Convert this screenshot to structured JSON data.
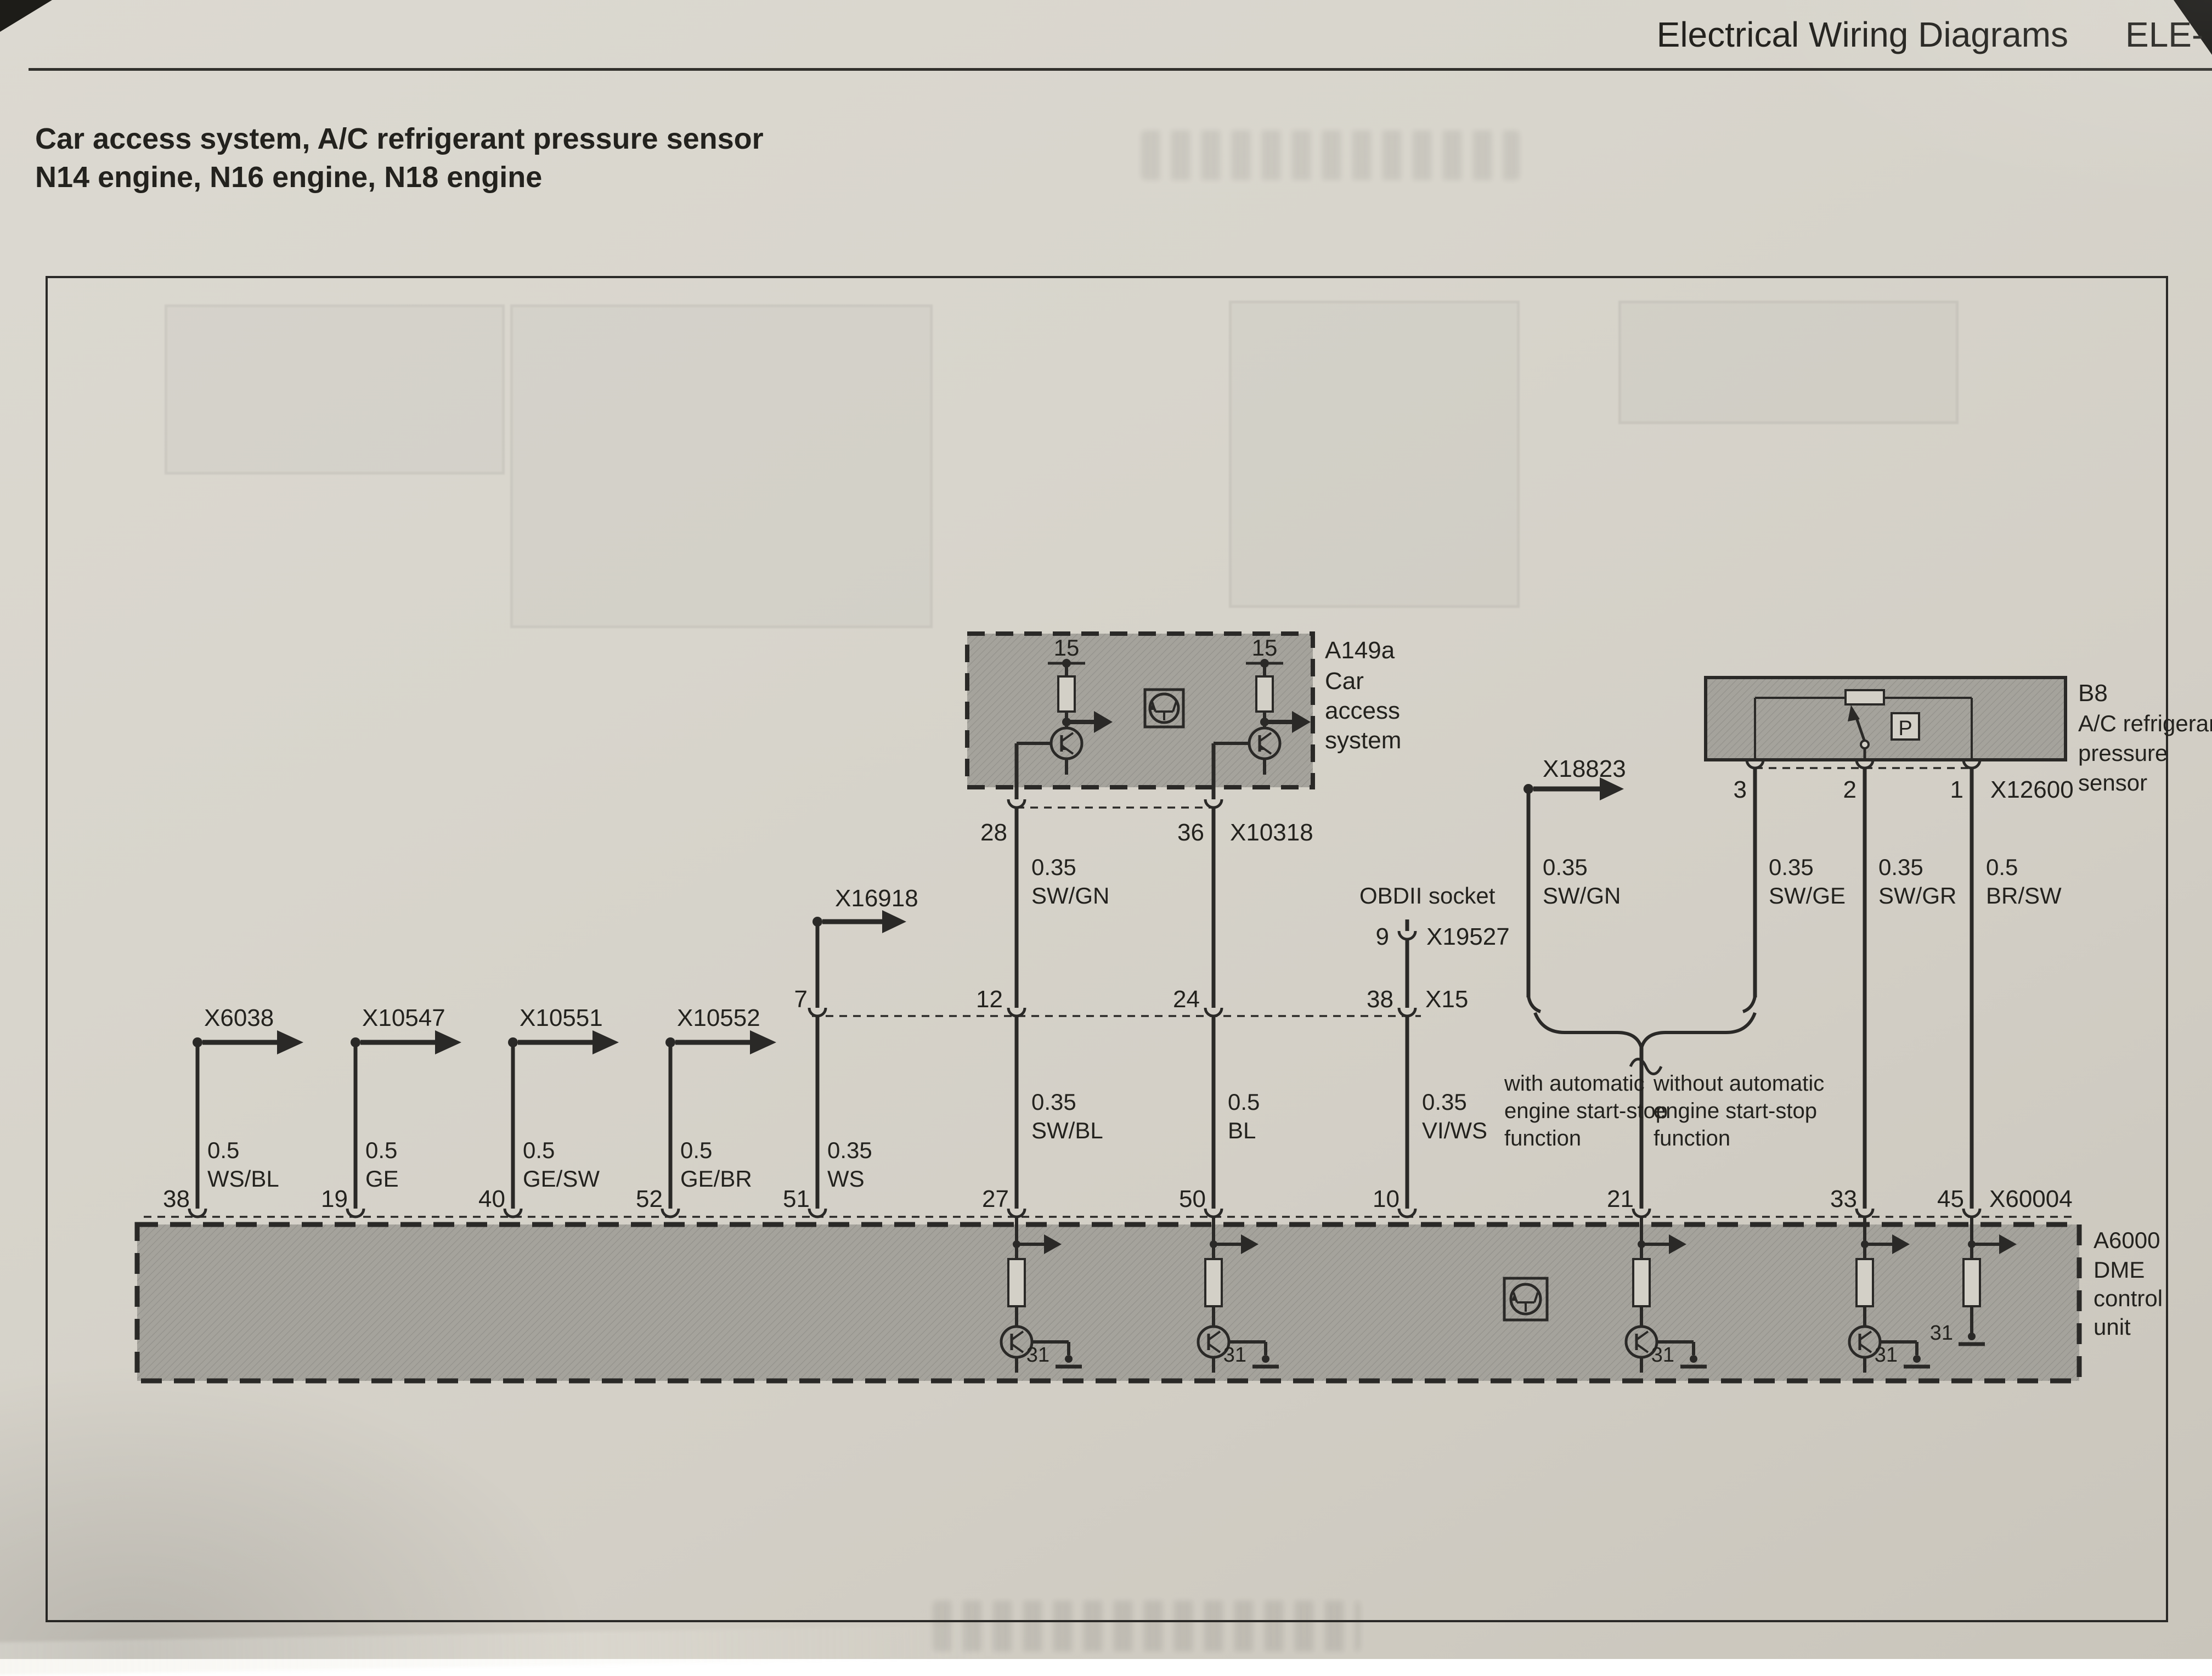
{
  "header": {
    "title": "Electrical Wiring Diagrams",
    "code": "ELE-"
  },
  "heading": {
    "line1": "Car access system, A/C refrigerant pressure sensor",
    "line2": "N14 engine, N16 engine, N18 engine"
  },
  "a149a": {
    "id": "A149a",
    "name": [
      "Car",
      "access",
      "system"
    ],
    "terminal": "15",
    "pin_left": "28",
    "pin_right": "36",
    "connector": "X10318"
  },
  "x16918": {
    "label": "X16918"
  },
  "x18823": {
    "label": "X18823",
    "size": "0.35",
    "color": "SW/GN"
  },
  "obdii": {
    "label": "OBDII socket",
    "pin": "9",
    "connector": "X19527"
  },
  "x15": {
    "label": "X15",
    "pins": [
      "7",
      "12",
      "24",
      "38"
    ]
  },
  "branches": {
    "x6038": "X6038",
    "x10547": "X10547",
    "x10551": "X10551",
    "x10552": "X10552"
  },
  "wires": {
    "swgn": {
      "size": "0.35",
      "color": "SW/GN"
    },
    "swbl": {
      "size": "0.35",
      "color": "SW/BL"
    },
    "bl": {
      "size": "0.5",
      "color": "BL"
    },
    "viws": {
      "size": "0.35",
      "color": "VI/WS"
    },
    "ws": {
      "size": "0.35",
      "color": "WS"
    },
    "wsbl": {
      "size": "0.5",
      "color": "WS/BL"
    },
    "ge": {
      "size": "0.5",
      "color": "GE"
    },
    "gesw": {
      "size": "0.5",
      "color": "GE/SW"
    },
    "gebr": {
      "size": "0.5",
      "color": "GE/BR"
    },
    "swge": {
      "size": "0.35",
      "color": "SW/GE"
    },
    "swgr": {
      "size": "0.35",
      "color": "SW/GR"
    },
    "brsw": {
      "size": "0.5",
      "color": "BR/SW"
    }
  },
  "b8": {
    "id": "B8",
    "name": [
      "A/C refrigerant",
      "pressure",
      "sensor"
    ],
    "symbol": "P",
    "pin3": "3",
    "pin2": "2",
    "pin1": "1",
    "connector": "X12600"
  },
  "notes": {
    "with": [
      "with automatic",
      "engine start-stop",
      "function"
    ],
    "without": [
      "without automatic",
      "engine start-stop",
      "function"
    ]
  },
  "dme": {
    "id": "A6000",
    "name": [
      "DME",
      "control",
      "unit"
    ],
    "connector": "X60004",
    "ground": "31",
    "pins": [
      "38",
      "19",
      "40",
      "52",
      "51",
      "27",
      "50",
      "10",
      "21",
      "33",
      "45"
    ]
  }
}
